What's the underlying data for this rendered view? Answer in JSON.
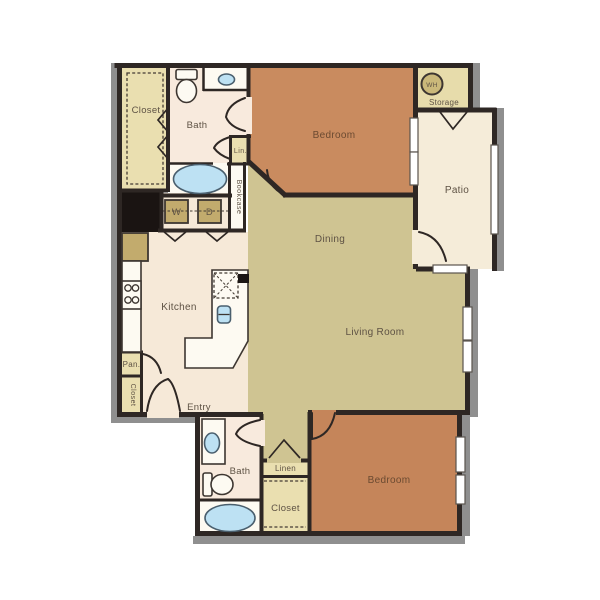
{
  "colors": {
    "wall": "#2e2724",
    "shadow": "#8f8f8f",
    "bedroom_top": "#c98b5f",
    "bedroom_bottom": "#c5855a",
    "living_olive": "#cfc492",
    "kitchen_cream": "#f6e9d8",
    "bath_cream": "#f8eadd",
    "closet_khaki": "#eadfb0",
    "storage_khaki": "#e7dcab",
    "patio_cream": "#f5ecd9",
    "fixture_white": "#fdfaf2",
    "water_blue": "#bde1f3",
    "appliance_tan": "#c2ab6d",
    "black_area": "#1a1412",
    "label_text": "#5e5244"
  },
  "rooms": {
    "closet_top_left": "Closet",
    "bath_top": "Bath",
    "linen_top": "Lin.",
    "bookcase": "Bookcase",
    "washer": "W",
    "dryer": "D",
    "bedroom_top": "Bedroom",
    "water_heater": "WH",
    "storage": "Storage",
    "patio": "Patio",
    "dining": "Dining",
    "kitchen": "Kitchen",
    "living_room": "Living Room",
    "pantry": "Pan.",
    "closet_left": "Closet",
    "entry": "Entry",
    "bath_bottom": "Bath",
    "linen_bottom": "Linen",
    "closet_bottom": "Closet",
    "bedroom_bottom": "Bedroom"
  }
}
